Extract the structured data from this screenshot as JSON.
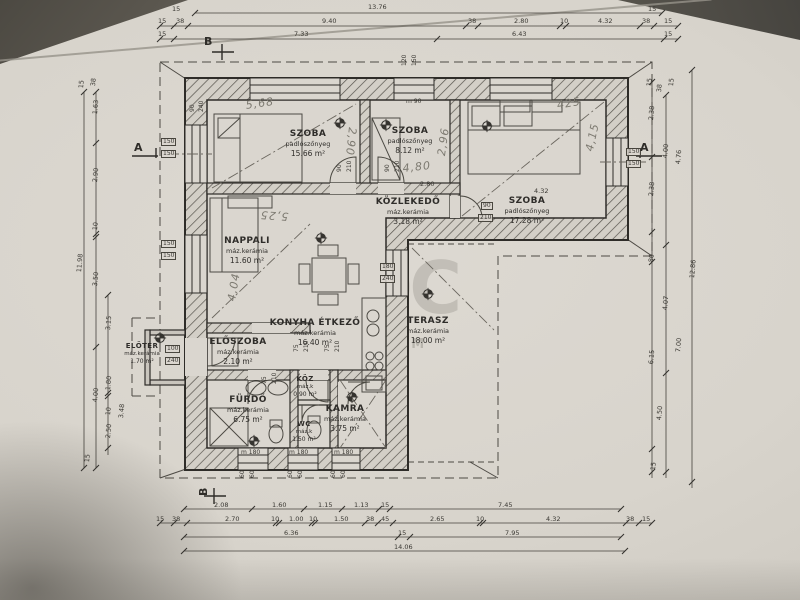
{
  "rooms": [
    {
      "name": "SZOBA",
      "finish": "padlószőnyeg",
      "area": "15.66 m²"
    },
    {
      "name": "SZOBA",
      "finish": "padlószőnyeg",
      "area": "8.12 m²"
    },
    {
      "name": "SZOBA",
      "finish": "padlószőnyeg",
      "area": "17.28 m²"
    },
    {
      "name": "KÖZLEKEDŐ",
      "finish": "máz.kerámia",
      "area": "3.18 m²"
    },
    {
      "name": "NAPPALI",
      "finish": "máz.kerámia",
      "area": "11.60 m²"
    },
    {
      "name": "KONYHA ÉTKEZŐ",
      "finish": "máz.kerámia",
      "area": "16.40 m²"
    },
    {
      "name": "TERASZ",
      "finish": "máz.kerámia",
      "area": "18.00 m²"
    },
    {
      "name": "ELŐSZOBA",
      "finish": "máz.kerámia",
      "area": "2.10 m²"
    },
    {
      "name": "ELŐTÉR",
      "finish": "máz.kerámia",
      "area": "1.70 m²"
    },
    {
      "name": "FÜRDŐ",
      "finish": "máz.kerámia",
      "area": "6.75 m²"
    },
    {
      "name": "KÖZ",
      "finish": "máz.k",
      "area": "0.90 m²"
    },
    {
      "name": "WC",
      "finish": "máz.k",
      "area": "1.50 m²"
    },
    {
      "name": "KAMRA",
      "finish": "máz.kerámia",
      "area": "3.75 m²"
    }
  ],
  "dims": [
    {
      "t": "13.76",
      "x": 368,
      "y": 4
    },
    {
      "t": "15",
      "x": 172,
      "y": 6
    },
    {
      "t": "15",
      "x": 648,
      "y": 6
    },
    {
      "t": "15",
      "x": 158,
      "y": 18
    },
    {
      "t": "38",
      "x": 176,
      "y": 18
    },
    {
      "t": "9.40",
      "x": 322,
      "y": 18
    },
    {
      "t": "38",
      "x": 468,
      "y": 18
    },
    {
      "t": "2.80",
      "x": 514,
      "y": 18
    },
    {
      "t": "10",
      "x": 560,
      "y": 18
    },
    {
      "t": "4.32",
      "x": 598,
      "y": 18
    },
    {
      "t": "38",
      "x": 642,
      "y": 18
    },
    {
      "t": "15",
      "x": 664,
      "y": 18
    },
    {
      "t": "15",
      "x": 158,
      "y": 31
    },
    {
      "t": "7.33",
      "x": 294,
      "y": 31
    },
    {
      "t": "6.43",
      "x": 512,
      "y": 31
    },
    {
      "t": "15",
      "x": 664,
      "y": 31
    },
    {
      "t": "2.08",
      "x": 214,
      "y": 502
    },
    {
      "t": "1.60",
      "x": 272,
      "y": 502
    },
    {
      "t": "1.15",
      "x": 318,
      "y": 502
    },
    {
      "t": "1.13",
      "x": 354,
      "y": 502
    },
    {
      "t": "15",
      "x": 381,
      "y": 502
    },
    {
      "t": "7.45",
      "x": 498,
      "y": 502
    },
    {
      "t": "15",
      "x": 156,
      "y": 516
    },
    {
      "t": "38",
      "x": 172,
      "y": 516
    },
    {
      "t": "2.70",
      "x": 225,
      "y": 516
    },
    {
      "t": "10",
      "x": 271,
      "y": 516
    },
    {
      "t": "1.00",
      "x": 289,
      "y": 516
    },
    {
      "t": "10",
      "x": 309,
      "y": 516
    },
    {
      "t": "1.50",
      "x": 334,
      "y": 516
    },
    {
      "t": "38",
      "x": 366,
      "y": 516
    },
    {
      "t": "45",
      "x": 381,
      "y": 516
    },
    {
      "t": "2.65",
      "x": 430,
      "y": 516
    },
    {
      "t": "10",
      "x": 476,
      "y": 516
    },
    {
      "t": "4.32",
      "x": 546,
      "y": 516
    },
    {
      "t": "38",
      "x": 626,
      "y": 516
    },
    {
      "t": "15",
      "x": 642,
      "y": 516
    },
    {
      "t": "6.36",
      "x": 284,
      "y": 530
    },
    {
      "t": "15",
      "x": 398,
      "y": 530
    },
    {
      "t": "7.95",
      "x": 505,
      "y": 530
    },
    {
      "t": "14.06",
      "x": 394,
      "y": 544
    },
    {
      "t": "11.98",
      "x": 76,
      "y": 272,
      "r": -85
    },
    {
      "t": "15",
      "x": 78,
      "y": 88,
      "r": -85
    },
    {
      "t": "38",
      "x": 90,
      "y": 86,
      "r": -85
    },
    {
      "t": "1.63",
      "x": 92,
      "y": 114,
      "r": -85
    },
    {
      "t": "2.90",
      "x": 92,
      "y": 182,
      "r": -85
    },
    {
      "t": "10",
      "x": 92,
      "y": 230,
      "r": -85
    },
    {
      "t": "3.50",
      "x": 92,
      "y": 286,
      "r": -85
    },
    {
      "t": "4.00",
      "x": 92,
      "y": 402,
      "r": -85
    },
    {
      "t": "3.15",
      "x": 105,
      "y": 330,
      "r": -85
    },
    {
      "t": "1.80",
      "x": 105,
      "y": 390,
      "r": -85
    },
    {
      "t": "10",
      "x": 105,
      "y": 415,
      "r": -85
    },
    {
      "t": "2.50",
      "x": 105,
      "y": 438,
      "r": -85
    },
    {
      "t": "3.48",
      "x": 118,
      "y": 418,
      "r": -85
    },
    {
      "t": "15",
      "x": 84,
      "y": 462,
      "r": -85
    },
    {
      "t": "2.38",
      "x": 648,
      "y": 120,
      "r": -85
    },
    {
      "t": "4.00",
      "x": 662,
      "y": 158,
      "r": -85
    },
    {
      "t": "4.76",
      "x": 675,
      "y": 164,
      "r": -85
    },
    {
      "t": "2.38",
      "x": 648,
      "y": 196,
      "r": -85
    },
    {
      "t": "80",
      "x": 648,
      "y": 262,
      "r": -85
    },
    {
      "t": "4.07",
      "x": 662,
      "y": 310,
      "r": -85
    },
    {
      "t": "7.00",
      "x": 675,
      "y": 352,
      "r": -85
    },
    {
      "t": "6.15",
      "x": 648,
      "y": 364,
      "r": -85
    },
    {
      "t": "4.50",
      "x": 656,
      "y": 420,
      "r": -85
    },
    {
      "t": "12.86",
      "x": 689,
      "y": 278,
      "r": -85
    },
    {
      "t": "15",
      "x": 646,
      "y": 86,
      "r": -85
    },
    {
      "t": "38",
      "x": 656,
      "y": 92,
      "r": -85
    },
    {
      "t": "15",
      "x": 668,
      "y": 86,
      "r": -85
    },
    {
      "t": "15",
      "x": 650,
      "y": 470,
      "r": -85
    },
    {
      "t": "2.80",
      "x": 420,
      "y": 181
    },
    {
      "t": "4.32",
      "x": 534,
      "y": 188
    }
  ],
  "openings": [
    {
      "t": "150",
      "x": 161,
      "y": 138,
      "b": 1
    },
    {
      "t": "150",
      "x": 161,
      "y": 150,
      "b": 1
    },
    {
      "t": "150",
      "x": 161,
      "y": 240,
      "b": 1
    },
    {
      "t": "150",
      "x": 161,
      "y": 252,
      "b": 1
    },
    {
      "t": "150",
      "x": 626,
      "y": 148,
      "b": 1
    },
    {
      "t": "150",
      "x": 626,
      "y": 160,
      "b": 1
    },
    {
      "t": "120",
      "x": 402,
      "y": 66,
      "r": -90
    },
    {
      "t": "150",
      "x": 412,
      "y": 66,
      "r": -90
    },
    {
      "t": "m 90",
      "x": 406,
      "y": 99
    },
    {
      "t": "m 180",
      "x": 241,
      "y": 450
    },
    {
      "t": "m 180",
      "x": 289,
      "y": 450
    },
    {
      "t": "m 180",
      "x": 334,
      "y": 450
    },
    {
      "t": "90",
      "x": 481,
      "y": 202,
      "b": 1
    },
    {
      "t": "210",
      "x": 478,
      "y": 214,
      "b": 1
    },
    {
      "t": "90",
      "x": 337,
      "y": 172,
      "r": -90
    },
    {
      "t": "210",
      "x": 347,
      "y": 172,
      "r": -90
    },
    {
      "t": "90",
      "x": 385,
      "y": 172,
      "r": -90
    },
    {
      "t": "210",
      "x": 395,
      "y": 172,
      "r": -90
    },
    {
      "t": "75",
      "x": 262,
      "y": 384,
      "r": -90
    },
    {
      "t": "210",
      "x": 272,
      "y": 384,
      "r": -90
    },
    {
      "t": "75",
      "x": 294,
      "y": 352,
      "r": -90
    },
    {
      "t": "210",
      "x": 304,
      "y": 352,
      "r": -90
    },
    {
      "t": "75",
      "x": 325,
      "y": 352,
      "r": -90
    },
    {
      "t": "210",
      "x": 335,
      "y": 352,
      "r": -90
    },
    {
      "t": "100",
      "x": 165,
      "y": 345,
      "b": 1
    },
    {
      "t": "240",
      "x": 165,
      "y": 357,
      "b": 1
    },
    {
      "t": "180",
      "x": 380,
      "y": 263,
      "b": 1
    },
    {
      "t": "240",
      "x": 380,
      "y": 275,
      "b": 1
    },
    {
      "t": "60",
      "x": 240,
      "y": 478,
      "r": -90
    },
    {
      "t": "60",
      "x": 250,
      "y": 478,
      "r": -90
    },
    {
      "t": "60",
      "x": 288,
      "y": 478,
      "r": -90
    },
    {
      "t": "60",
      "x": 298,
      "y": 478,
      "r": -90
    },
    {
      "t": "60",
      "x": 331,
      "y": 478,
      "r": -90
    },
    {
      "t": "60",
      "x": 341,
      "y": 478,
      "r": -90
    },
    {
      "t": "90",
      "x": 190,
      "y": 112,
      "r": -90
    },
    {
      "t": "240",
      "x": 199,
      "y": 112,
      "r": -90
    }
  ],
  "handwritten": [
    {
      "t": "5,68",
      "x": 245,
      "y": 100,
      "r": -8
    },
    {
      "t": "5,25",
      "x": 288,
      "y": 222,
      "r": 184
    },
    {
      "t": "4,04",
      "x": 226,
      "y": 300,
      "r": -80
    },
    {
      "t": "2,96",
      "x": 436,
      "y": 155,
      "r": -82
    },
    {
      "t": "4,80",
      "x": 402,
      "y": 163,
      "r": -6
    },
    {
      "t": "425",
      "x": 556,
      "y": 100,
      "r": -10
    },
    {
      "t": "4,15",
      "x": 584,
      "y": 150,
      "r": -78
    },
    {
      "t": "2,90",
      "x": 358,
      "y": 128,
      "r": 96
    }
  ],
  "sections": [
    {
      "t": "A",
      "x": 134,
      "y": 142
    },
    {
      "t": "A",
      "x": 640,
      "y": 142
    },
    {
      "t": "B",
      "x": 204,
      "y": 36
    },
    {
      "t": "B",
      "x": 198,
      "y": 496,
      "r": -90
    }
  ],
  "watermark": {
    "big": "OC",
    "line1": "TTH",
    "line2": "ENTRUM"
  },
  "colors": {
    "paper": "#d8d4cc",
    "ink": "#35332f",
    "pencil": "#7d7a71",
    "watermark": "#8f8c83"
  }
}
